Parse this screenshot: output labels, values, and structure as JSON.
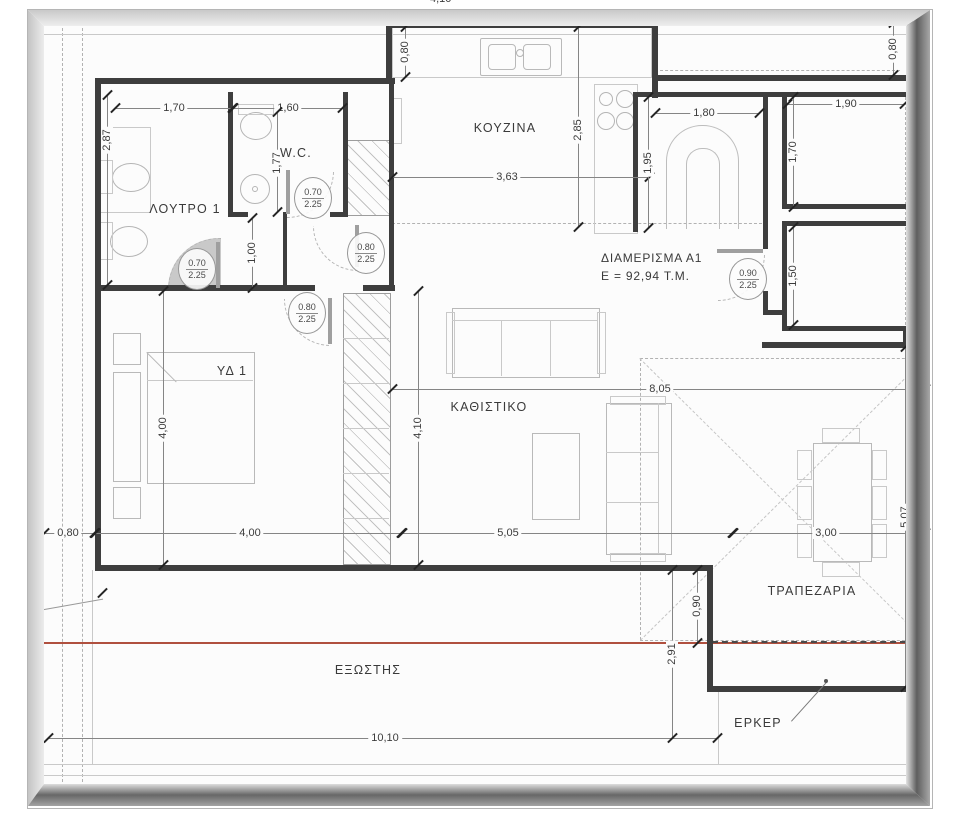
{
  "apartment": {
    "name": "ΔΙΑΜΕΡΙΣΜΑ Α1",
    "area": "Ε =  92,94 Τ.Μ."
  },
  "rooms": {
    "kitchen": "ΚΟΥΖΙΝΑ",
    "wc": "W.C.",
    "bath": "ΛΟΥΤΡΟ 1",
    "bedroom": "ΥΔ 1",
    "living": "ΚΑΘΙΣΤΙΚΟ",
    "dining": "ΤΡΑΠΕΖΑΡΙΑ",
    "balcony": "ΕΞΩΣΤΗΣ",
    "bay_window": "ΕΡΚΕΡ"
  },
  "dims": {
    "bath_w": "1,70",
    "wc_w": "1,60",
    "bath_h": "2,87",
    "wc_h": "1,77",
    "hall": "1,00",
    "kitchen_counter": "0,80",
    "kitchen_w": "3,63",
    "kitchen_h": "2,85",
    "entry_w": "1,80",
    "entry_h": "1,95",
    "porch1_w": "1,90",
    "porch1_h": "1,70",
    "porch2_h": "1,50",
    "top_right_d": "0,80",
    "left_offset": "0,80",
    "bed_w": "4,00",
    "bed_h": "4,00",
    "living_h": "4,10",
    "living_w": "5,05",
    "living_total": "8,05",
    "dining_w": "3,00",
    "dining_h": "5,07",
    "bay_step": "0,90",
    "balcony_d": "2,91",
    "balcony_w": "10,10",
    "bay_d": "0,80",
    "top_partial": "4,10"
  },
  "door_tags": [
    {
      "w": "0.70",
      "h": "2.25"
    },
    {
      "w": "0.70",
      "h": "2.25"
    },
    {
      "w": "0.80",
      "h": "2.25"
    },
    {
      "w": "0.80",
      "h": "2.25"
    },
    {
      "w": "0.90",
      "h": "2.25"
    }
  ],
  "colors": {
    "wall": "#3e3e3e",
    "dim_line": "#858585",
    "furniture": "#b9b9b9",
    "red_line": "#b0503f"
  }
}
